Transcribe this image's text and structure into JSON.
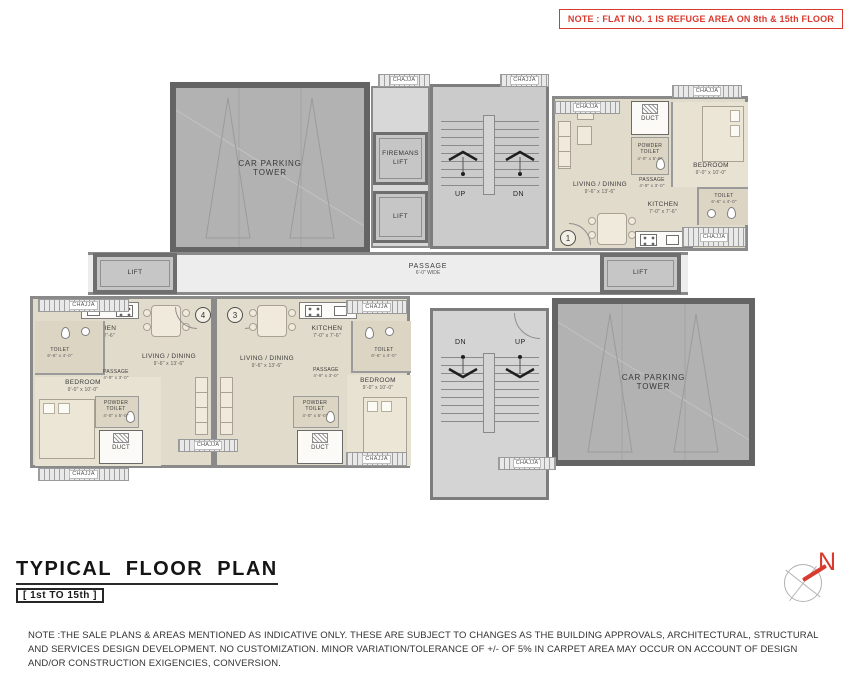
{
  "note": {
    "text": "NOTE : FLAT NO. 1 IS REFUGE AREA ON 8th & 15th FLOOR"
  },
  "title": {
    "main": "TYPICAL FLOOR PLAN",
    "range": "[ 1st TO 15th ]"
  },
  "compass": {
    "north": "N"
  },
  "disclaimer": {
    "line1": "NOTE :THE SALE PLANS & AREAS MENTIONED AS INDICATIVE ONLY. THESE ARE SUBJECT TO CHANGES AS THE BUILDING APPROVALS, ARCHITECTURAL, STRUCTURAL",
    "line2": "AND  SERVICES DESIGN DEVELOPMENT. NO CUSTOMIZATION. MINOR VARIATION/TOLERANCE OF +/- OF 5% IN CARPET AREA MAY OCCUR ON ACCOUNT OF DESIGN",
    "line3": "AND/OR CONSTRUCTION EXIGENCIES, CONVERSION."
  },
  "labels": {
    "chajja": "CHAJJA",
    "lift": "LIFT",
    "firemans_line1": "FIREMANS",
    "firemans_line2": "LIFT",
    "car_parking_line1": "CAR PARKING",
    "car_parking_line2": "TOWER",
    "passage": "PASSAGE",
    "passage_width": "6'-0\" WIDE",
    "up": "UP",
    "dn": "DN",
    "duct": "DUCT",
    "living": "LIVING / DINING",
    "living_dim": "9'-6\" x 13'-6\"",
    "kitchen": "KITCHEN",
    "kitchen_dim": "7'-0\" x 7'-6\"",
    "bedroom": "BEDROOM",
    "bedroom_dim": "9'-0\" x 10'-0\"",
    "toilet": "TOILET",
    "toilet_dim": "6'-6\" x 4'-0\"",
    "powder_line1": "POWDER",
    "powder_line2": "TOILET",
    "powder_dim": "4'-0\" x 5'-0\"",
    "passage_flat": "PASSAGE",
    "passage_flat_dim": "4'-9\" x 3'-0\""
  },
  "flats": {
    "flat1": "1",
    "flat3": "3",
    "flat4": "4"
  },
  "colors": {
    "accent_red": "#d93a2e",
    "wall": "#8a8a8a",
    "flat_fill": "#e1dbcb",
    "parking_fill": "#b2b2b2"
  }
}
